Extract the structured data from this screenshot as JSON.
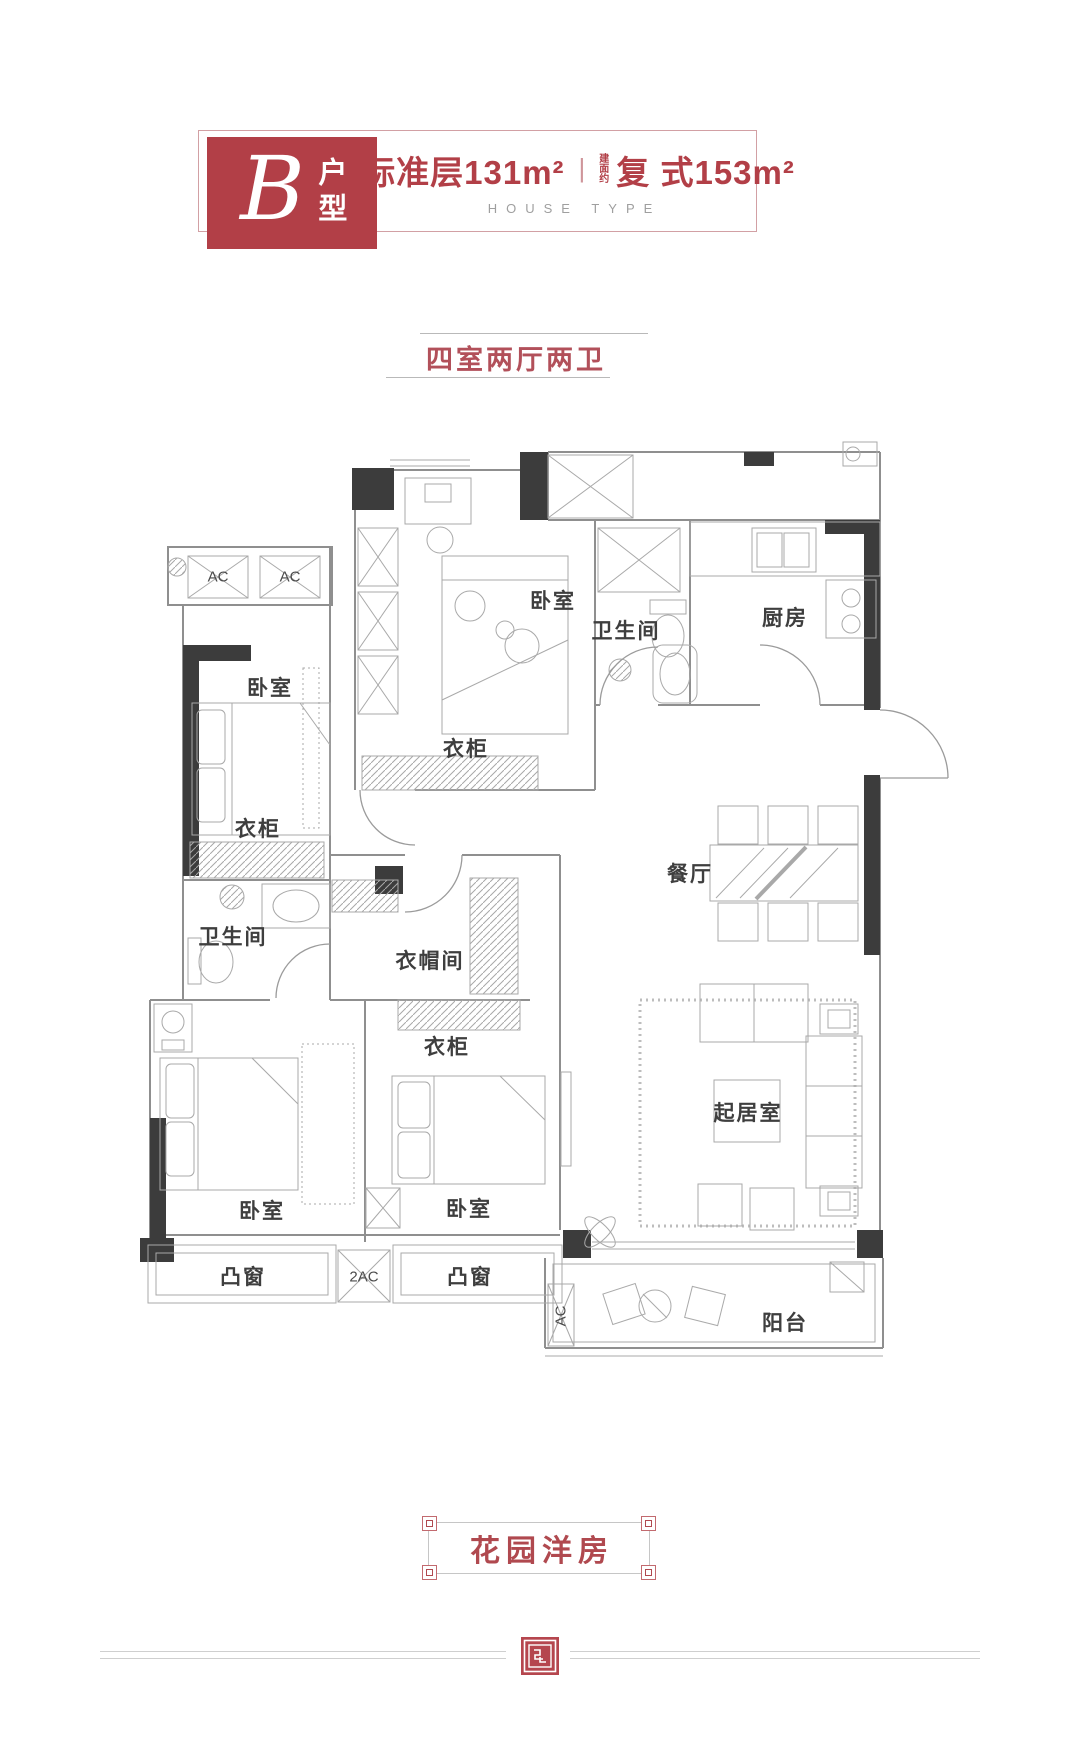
{
  "header": {
    "type_letter": "B",
    "type_label": "户型",
    "area1_prefix": "建面约",
    "area1_text": "标准层131m²",
    "separator": "|",
    "area2_prefix": "建面约",
    "area2_text": "复 式153m²",
    "subtitle_en": "HOUSE TYPE"
  },
  "layout_tag": "四室两厅两卫",
  "plan": {
    "labels": [
      {
        "text": "AC"
      },
      {
        "text": "AC"
      },
      {
        "text": "卧室"
      },
      {
        "text": "卧室"
      },
      {
        "text": "卫生间"
      },
      {
        "text": "厨房"
      },
      {
        "text": "衣柜"
      },
      {
        "text": "衣柜"
      },
      {
        "text": "餐厅"
      },
      {
        "text": "卫生间"
      },
      {
        "text": "衣帽间"
      },
      {
        "text": "衣柜"
      },
      {
        "text": "卧室"
      },
      {
        "text": "卧室"
      },
      {
        "text": "起居室"
      },
      {
        "text": "凸窗"
      },
      {
        "text": "2AC"
      },
      {
        "text": "凸窗"
      },
      {
        "text": "AC"
      },
      {
        "text": "阳台"
      }
    ]
  },
  "footer": {
    "banner": "花园洋房"
  },
  "colors": {
    "accent_red": "#b23f47",
    "banner_red": "#b0494f",
    "wall_gray": "#8f8f8f",
    "column_black": "#3c3c3c"
  }
}
